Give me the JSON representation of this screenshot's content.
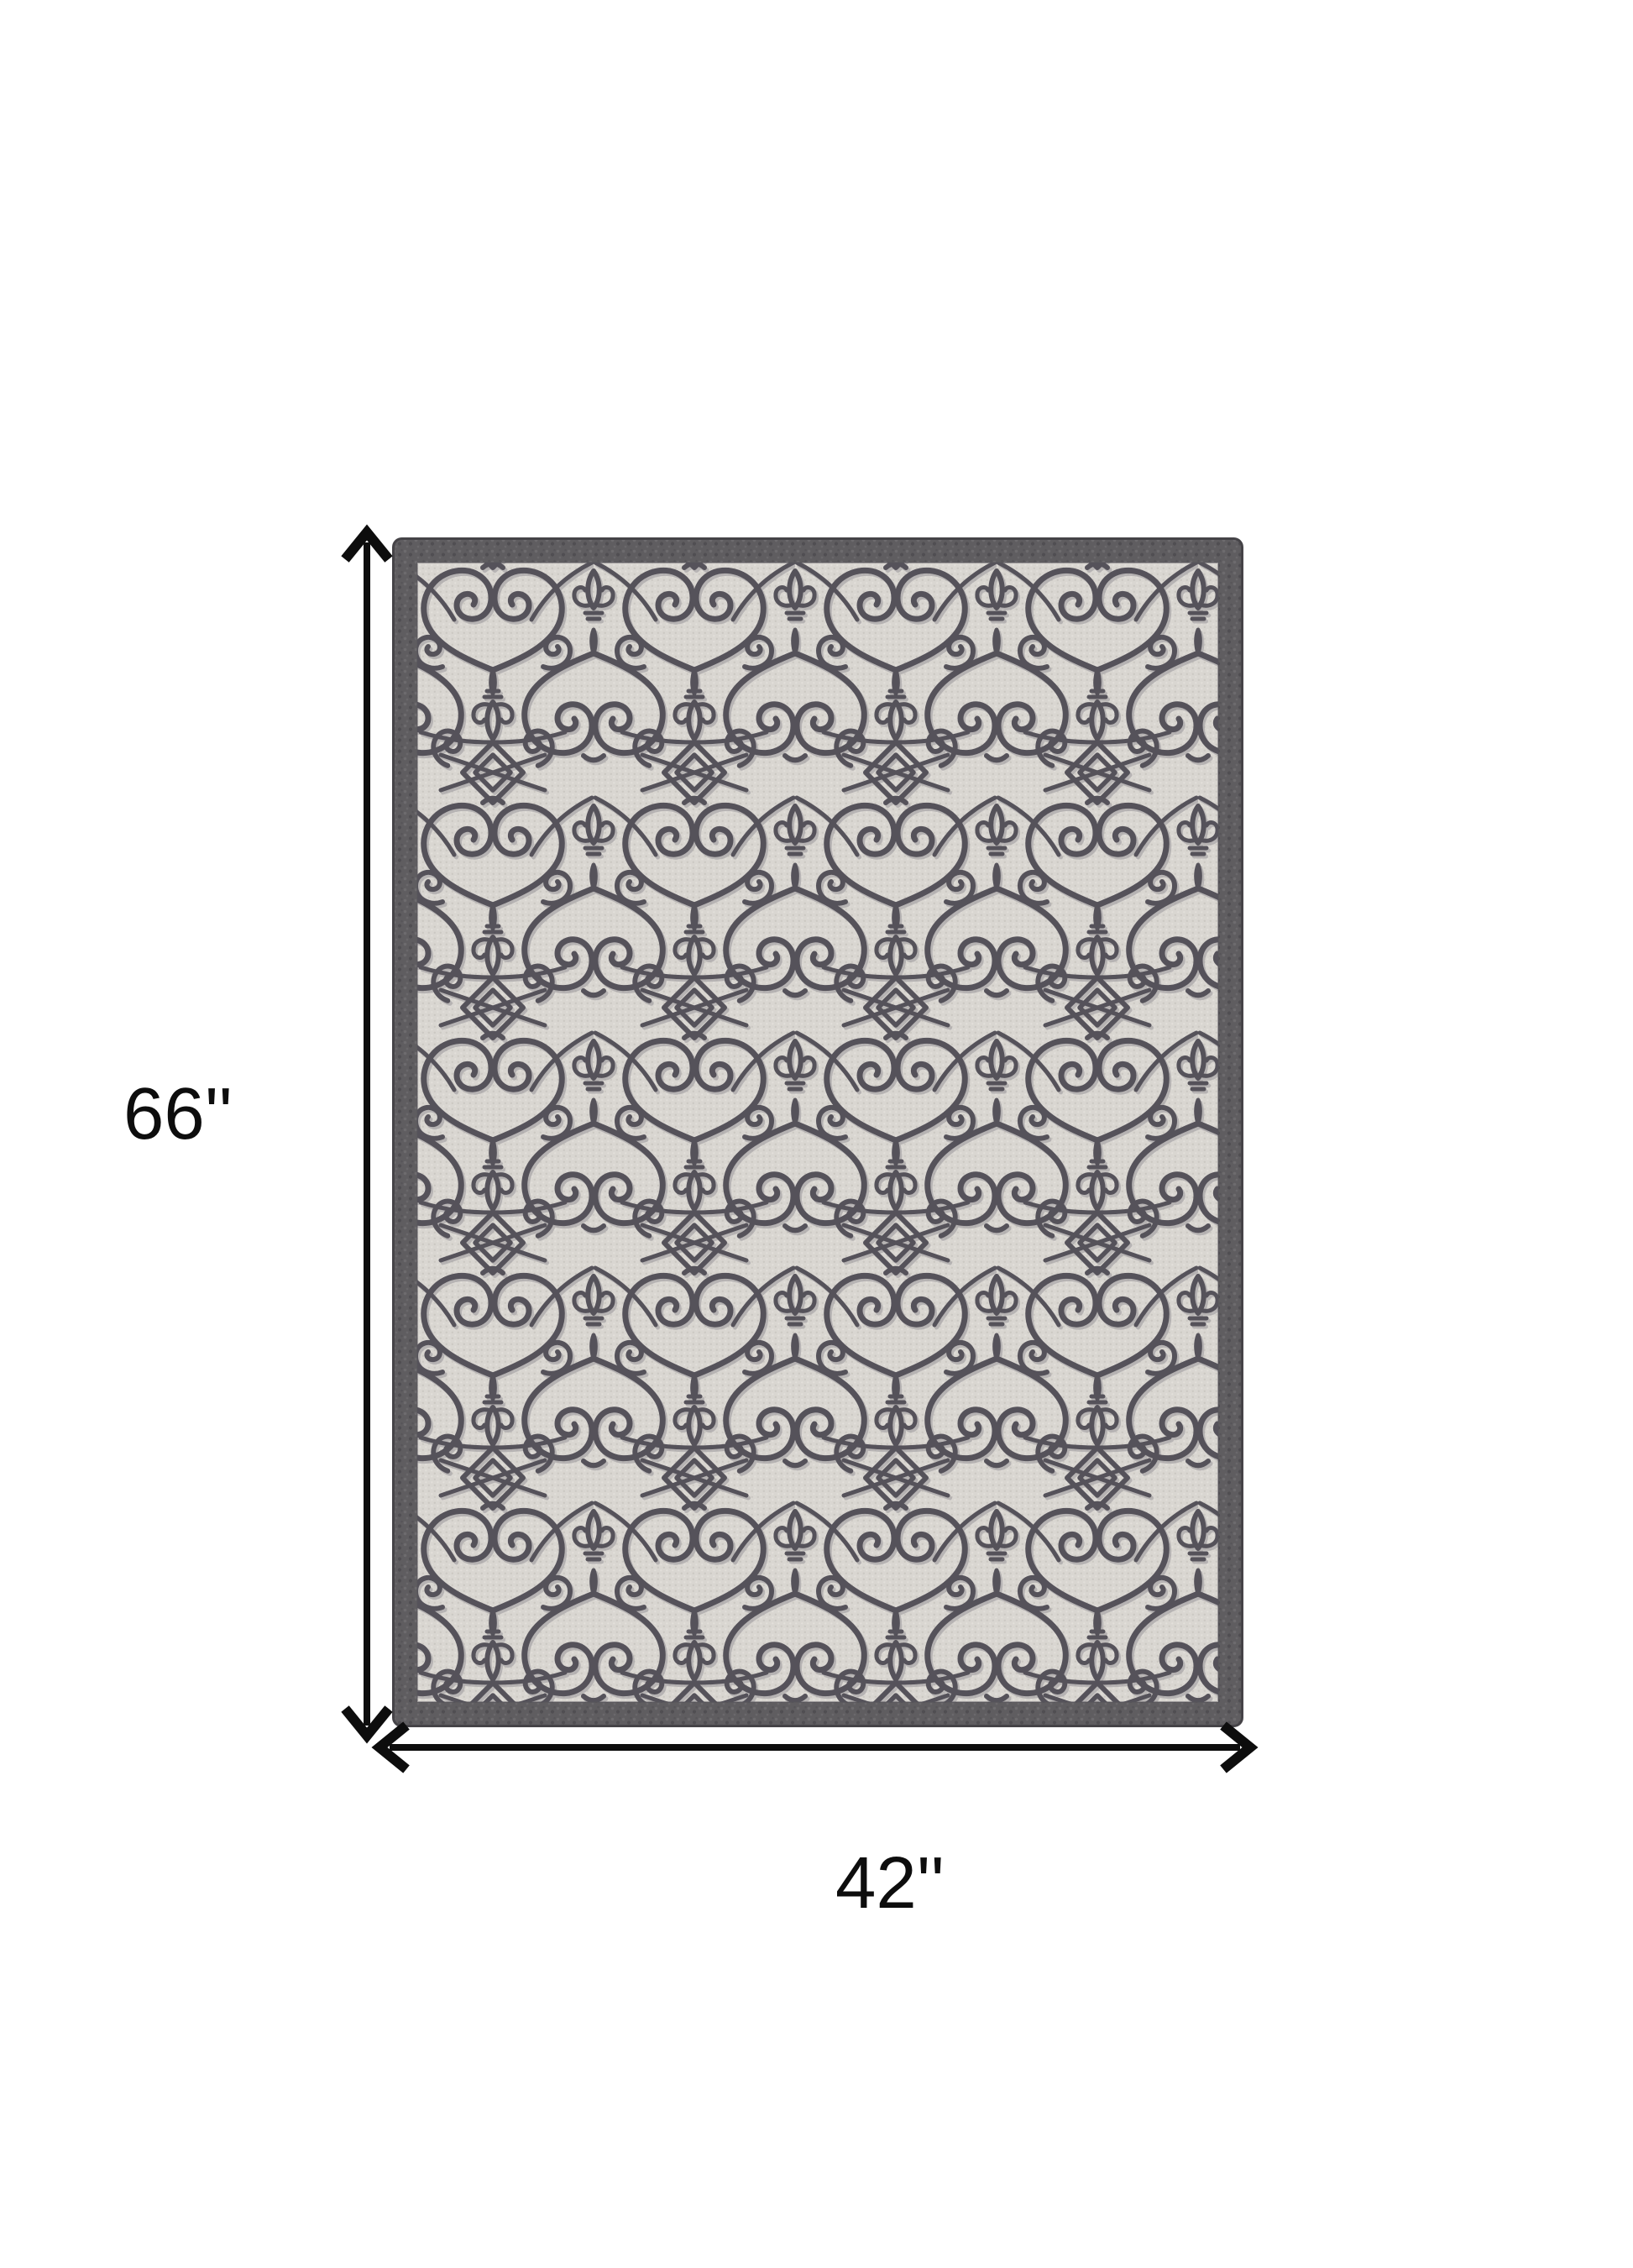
{
  "diagram": {
    "type": "product-dimension-diagram",
    "product": "ornamental-scroll-area-rug",
    "height_label": "66''",
    "width_label": "42''",
    "arrow_color": "#0d0d0d",
    "background_color": "#ffffff",
    "icons": {
      "vertical_arrow": "double-headed-vertical-arrow-icon",
      "horizontal_arrow": "double-headed-horizontal-arrow-icon"
    },
    "rug_colors": {
      "border": "#5f5d60",
      "border_edge": "#454347",
      "field": "#d9d6d1",
      "weave_dot": "#c9c6c0",
      "pattern_ink": "#55525a",
      "pattern_shadow": "#a3a0a3"
    }
  }
}
